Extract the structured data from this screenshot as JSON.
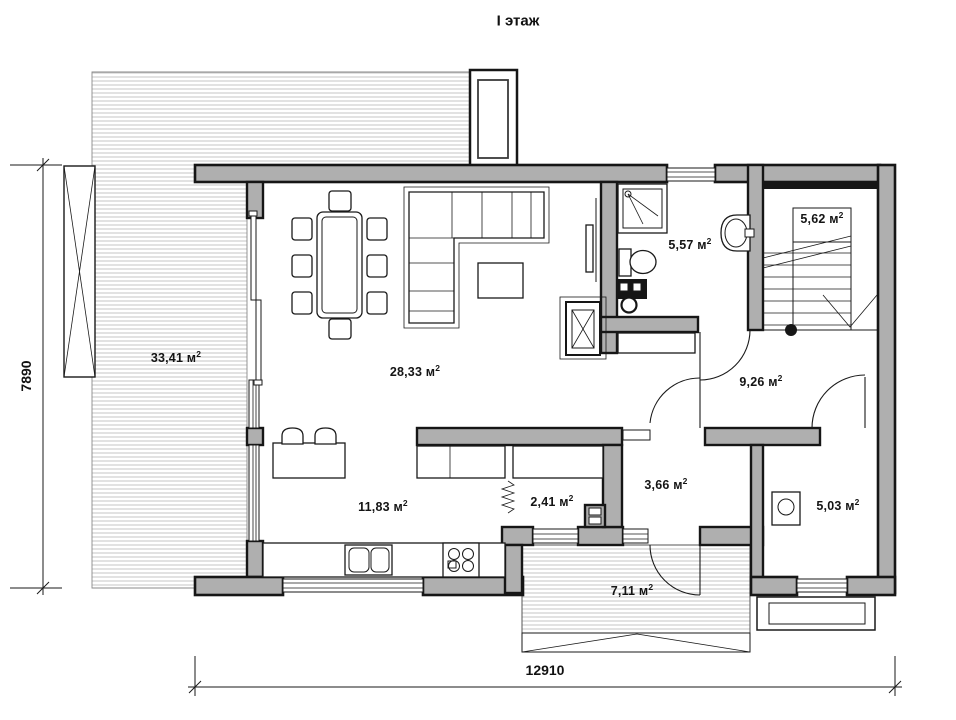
{
  "title": "I этаж",
  "units": {
    "base": " м",
    "sup": "2"
  },
  "rooms": {
    "terrace": {
      "area": "33,41"
    },
    "living": {
      "area": "28,33"
    },
    "bathroom": {
      "area": "5,57"
    },
    "staircase": {
      "area": "5,62"
    },
    "hall": {
      "area": "9,26"
    },
    "kitchen": {
      "area": "11,83"
    },
    "closet": {
      "area": "2,41"
    },
    "entry": {
      "area": "3,66"
    },
    "boiler_room": {
      "area": "5,03"
    },
    "porch": {
      "area": "7,11"
    }
  },
  "dimensions": {
    "total_width_mm": "12910",
    "total_height_mm": "7890"
  },
  "colors": {
    "wall_fill": "#afafaf",
    "outline": "#161616",
    "hatch_line": "#c6c6c6",
    "label_text": "#141414"
  }
}
